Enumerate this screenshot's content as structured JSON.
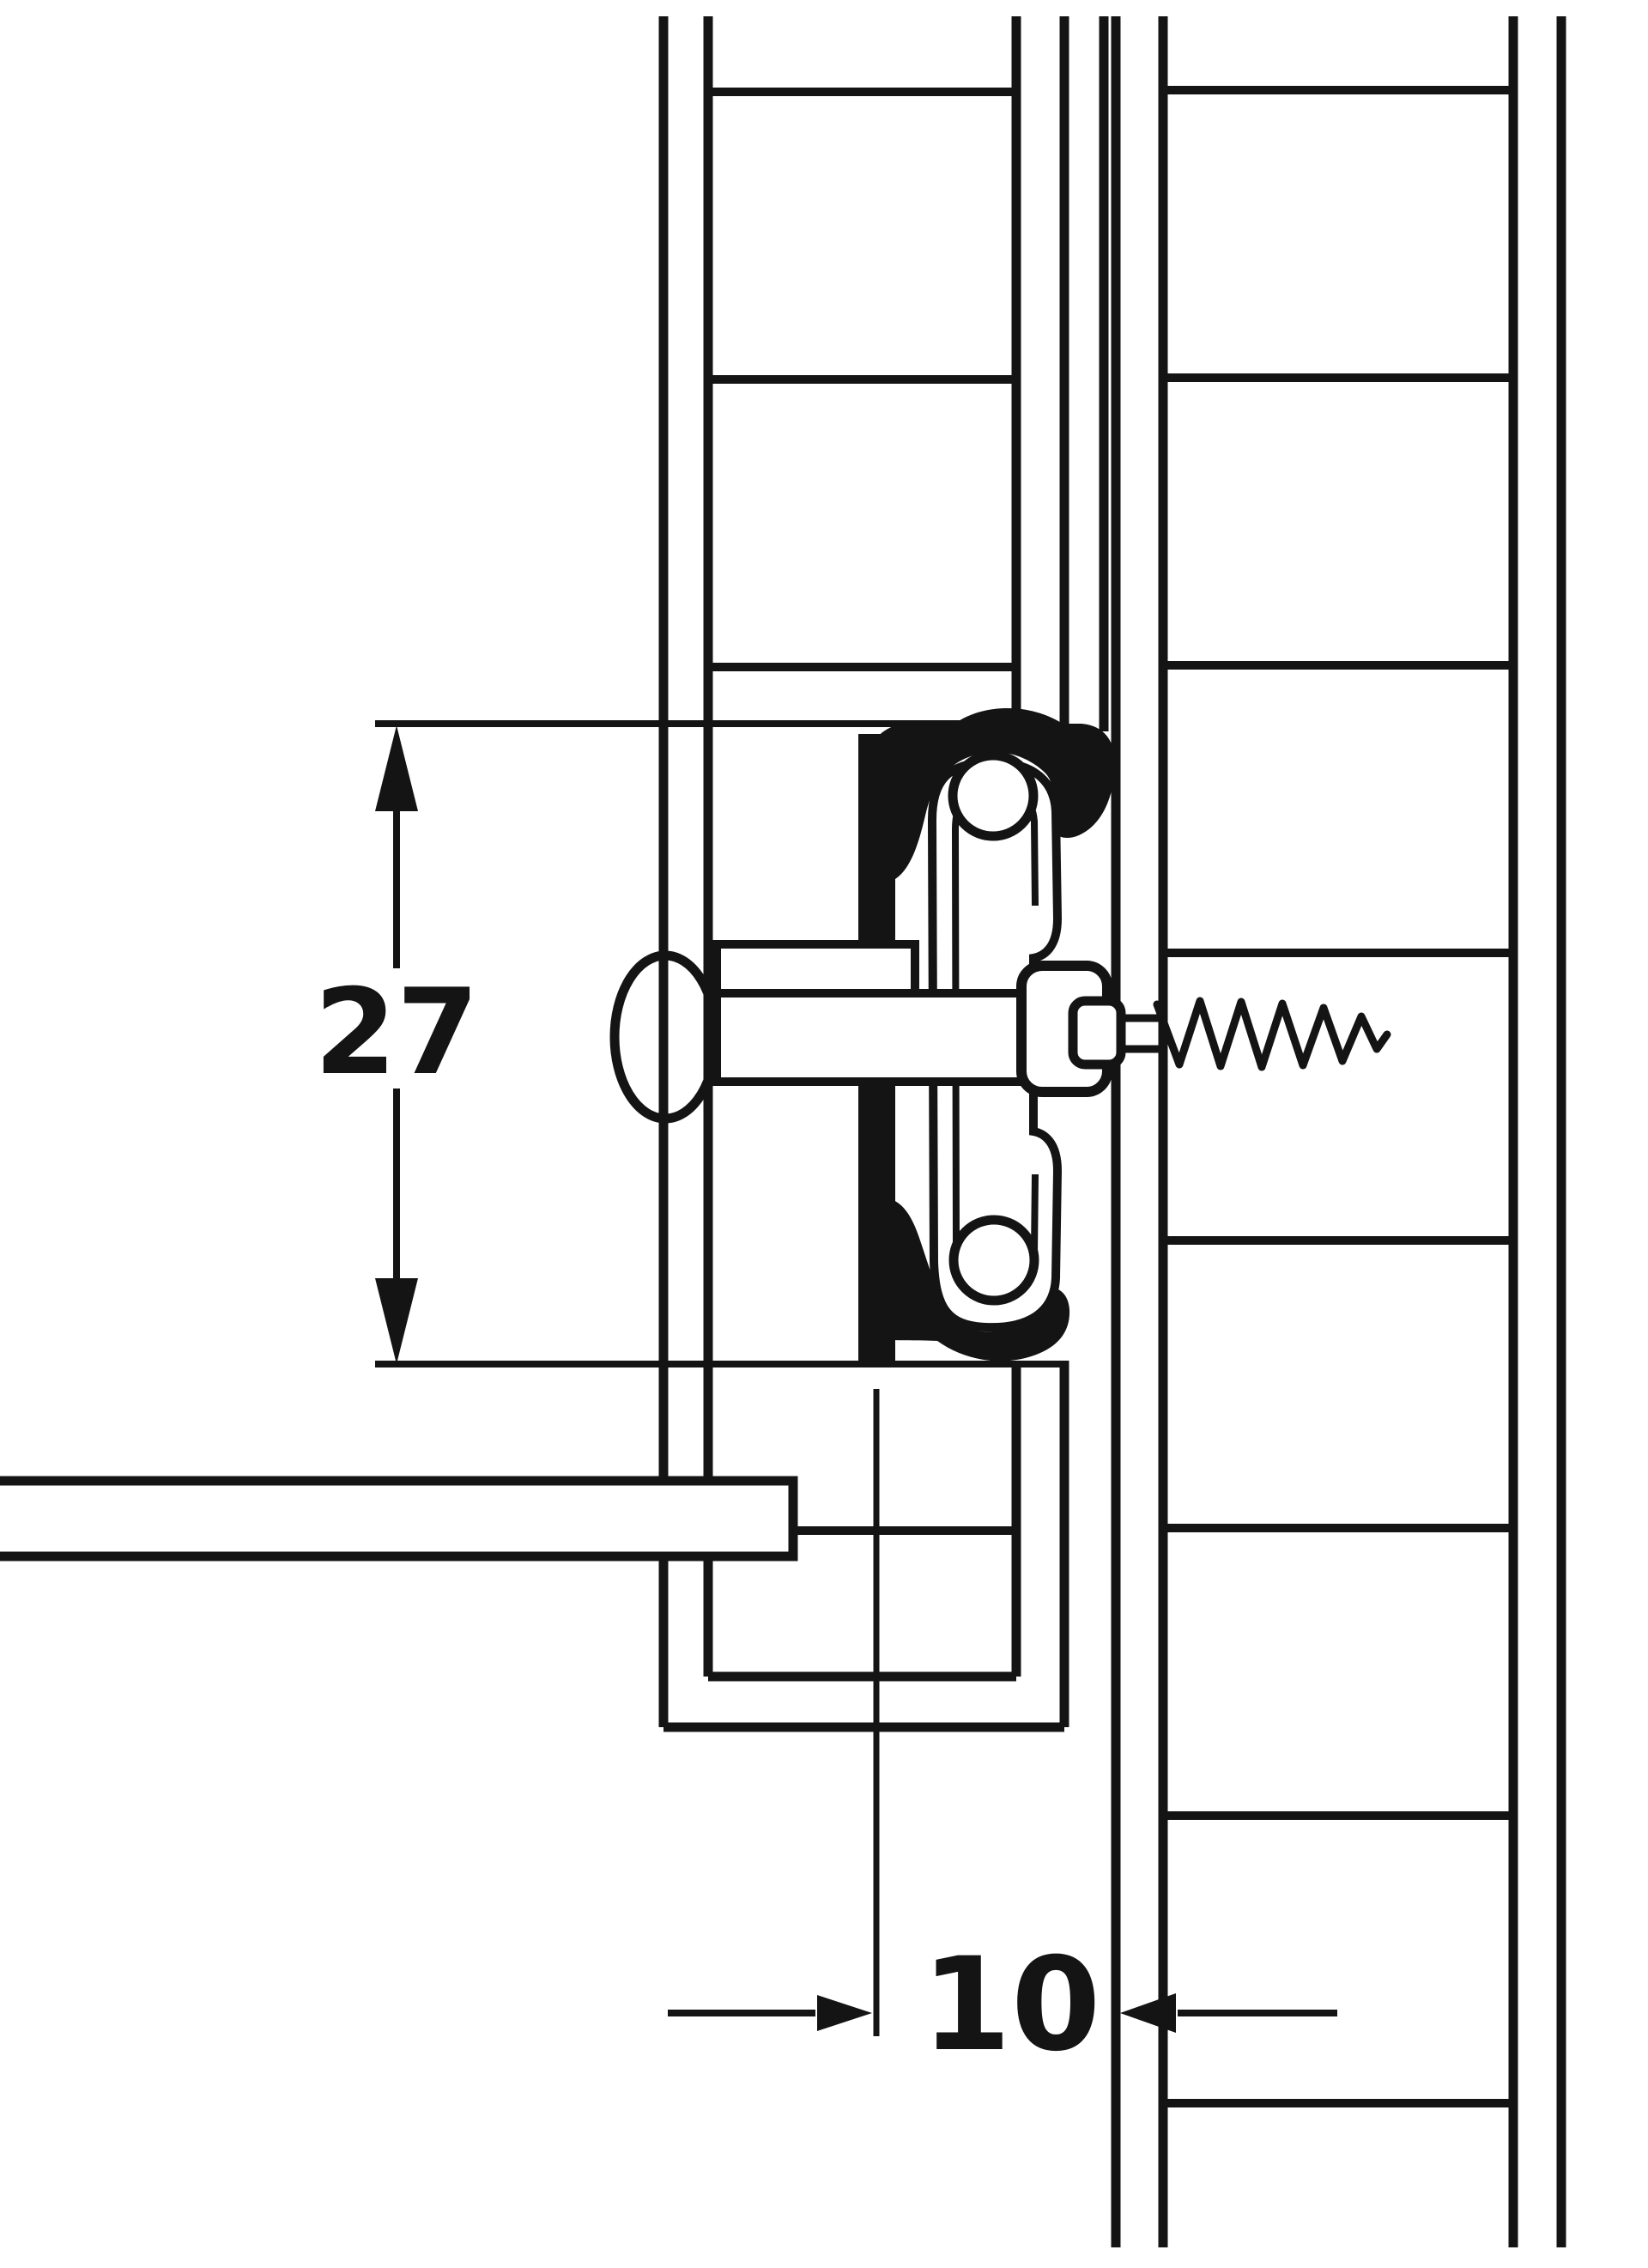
{
  "drawing": {
    "background_color": "#ffffff",
    "line_color": "#141414",
    "dimensions": {
      "groove_height": {
        "label": "27"
      },
      "side_clearance": {
        "label": "10"
      }
    }
  }
}
